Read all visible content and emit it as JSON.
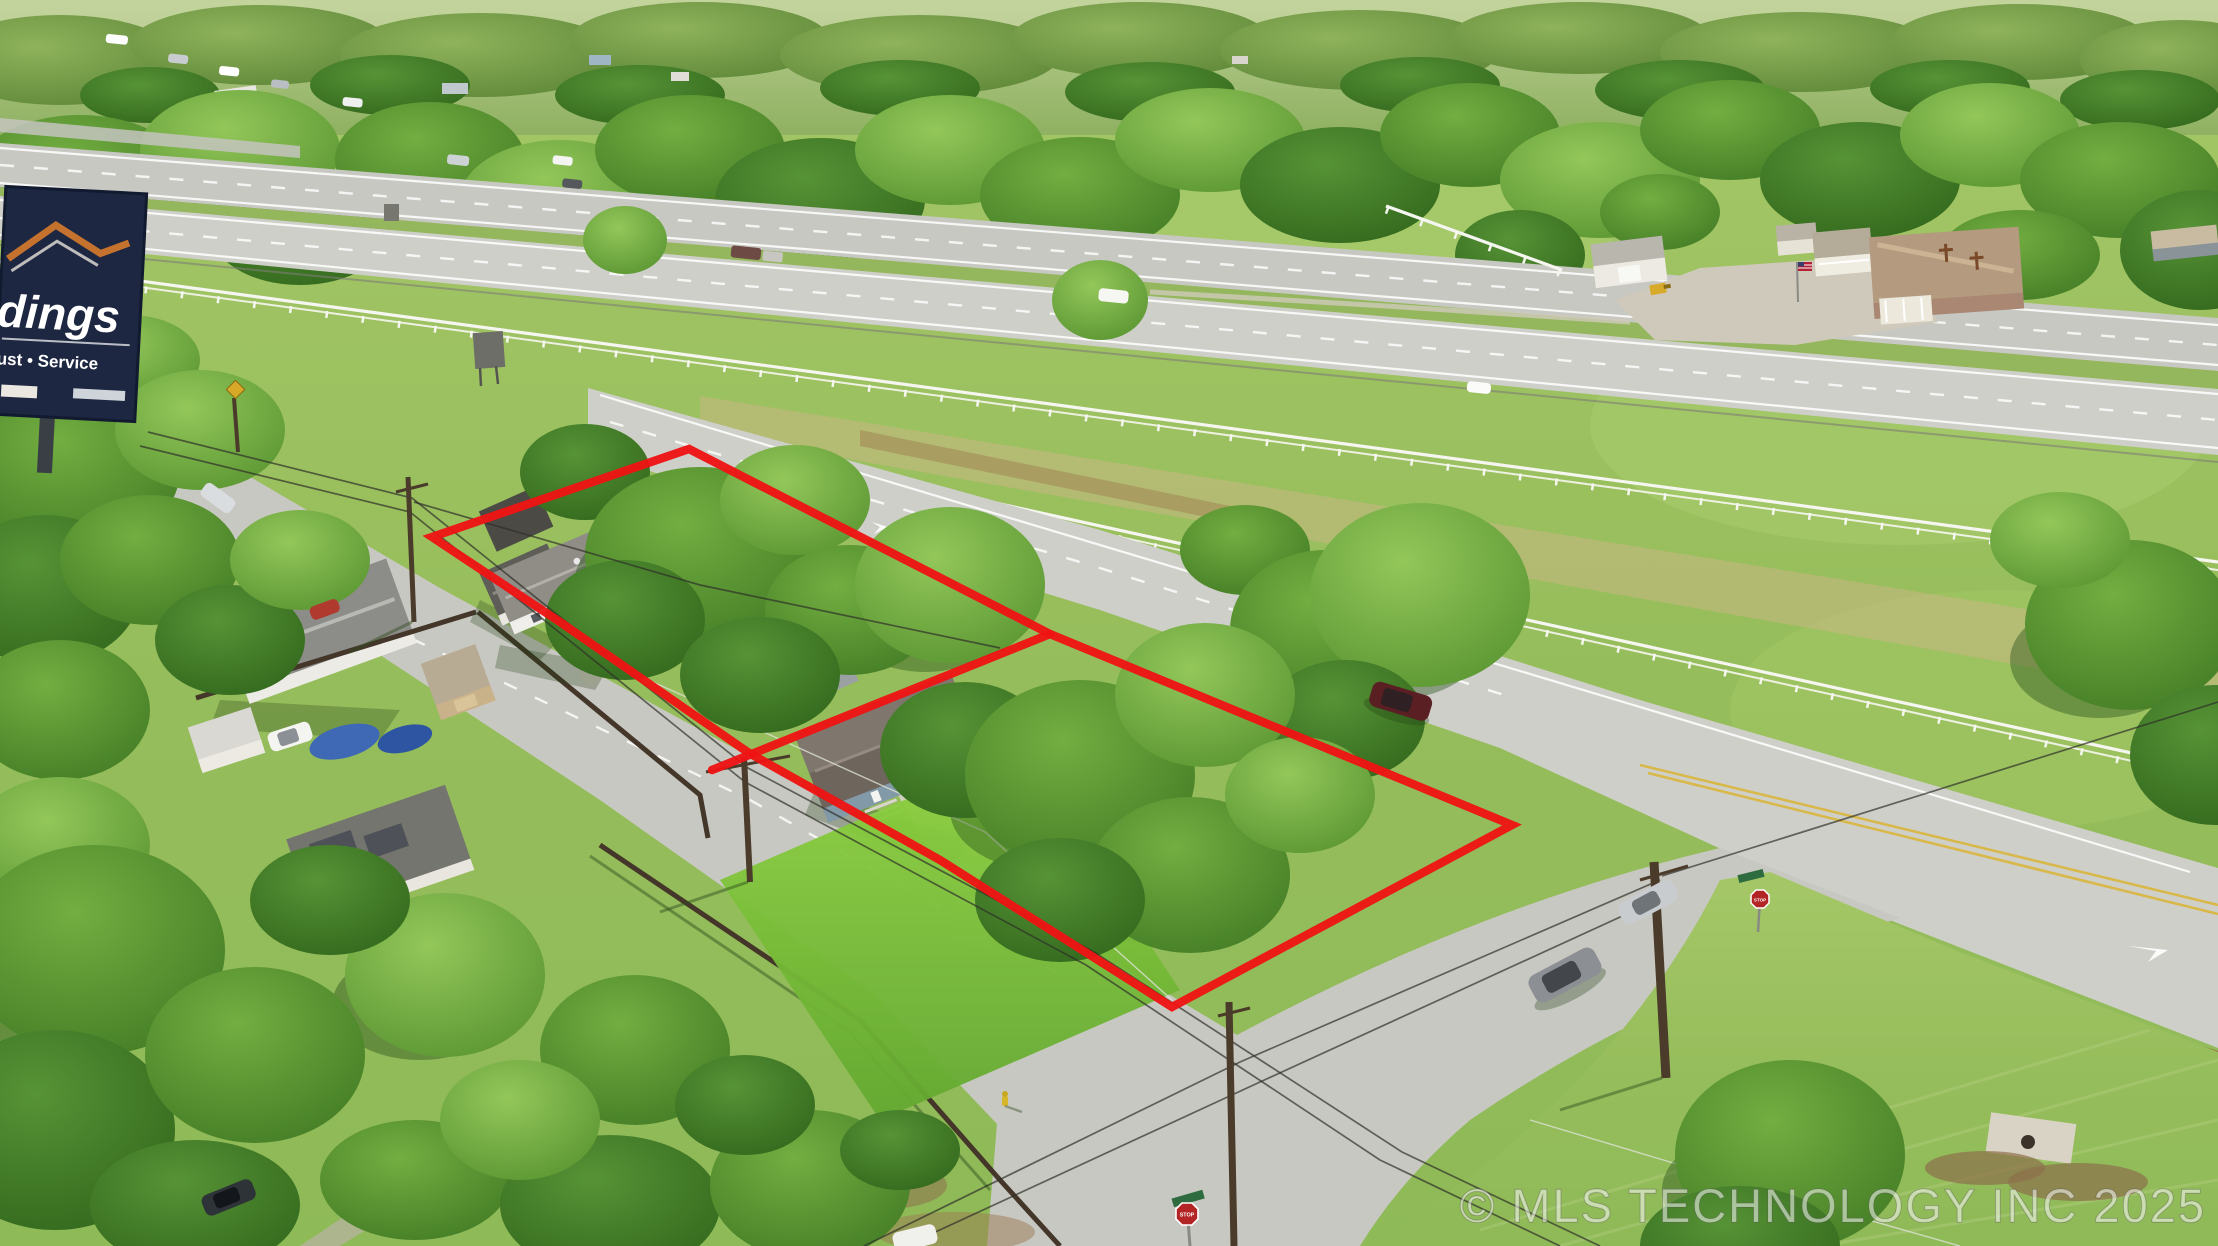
{
  "watermark": {
    "text": "© MLS TECHNOLOGY INC 2025"
  },
  "billboard": {
    "line1": "dings",
    "line2": "ust • Service"
  },
  "signs": {
    "stop_sign_1": "STOP",
    "stop_sign_2": "STOP"
  },
  "colors": {
    "boundary_red": "#ee1414",
    "watermark_fill": "rgba(255,255,255,0.52)",
    "billboard_navy": "#1d2742",
    "billboard_accent": "#c4722e"
  }
}
